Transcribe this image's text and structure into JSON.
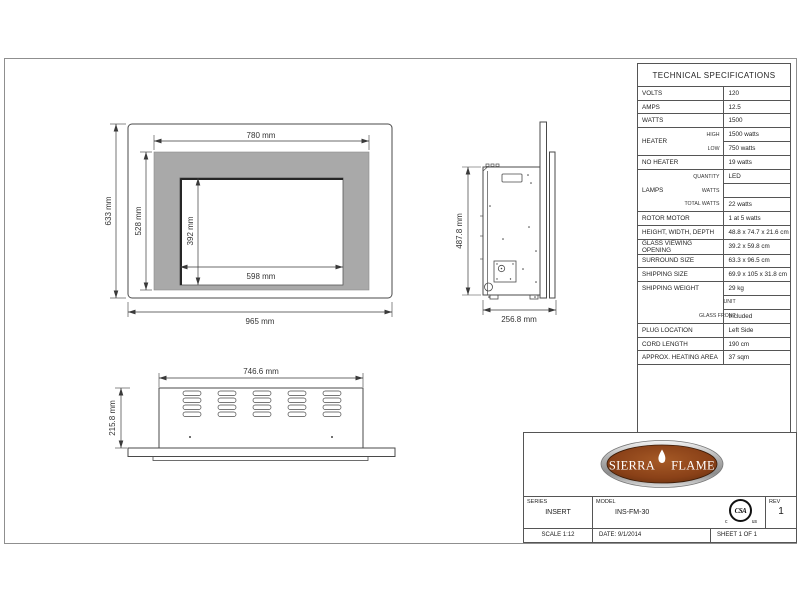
{
  "front_view": {
    "surround_width": "780 mm",
    "opening_width": "598 mm",
    "opening_height": "392 mm",
    "surround_height": "528 mm",
    "overall_height": "633 mm",
    "overall_width": "965 mm"
  },
  "side_view": {
    "height": "487.8 mm",
    "depth": "256.8 mm"
  },
  "top_view": {
    "width": "746.6 mm",
    "depth": "215.8 mm"
  },
  "specs": {
    "title": "TECHNICAL SPECIFICATIONS",
    "rows": [
      {
        "label": "VOLTS",
        "value": "120"
      },
      {
        "label": "AMPS",
        "value": "12.5"
      },
      {
        "label": "WATTS",
        "value": "1500"
      },
      {
        "group": "HEATER",
        "sub": "HIGH",
        "value": "1500 watts"
      },
      {
        "sub": "LOW",
        "value": "750 watts"
      },
      {
        "label": "NO HEATER",
        "value": "19 watts"
      },
      {
        "group": "LAMPS",
        "sub": "QUANTITY",
        "value": "LED"
      },
      {
        "sub": "WATTS",
        "value": ""
      },
      {
        "sub": "TOTAL WATTS",
        "value": "22 watts"
      },
      {
        "label": "ROTOR MOTOR",
        "value": "1 at 5 watts"
      },
      {
        "label": "HEIGHT, WIDTH, DEPTH",
        "value": "48.8 x 74.7 x 21.6 cm"
      },
      {
        "label": "GLASS VIEWING OPENING",
        "value": "39.2 x 59.8 cm"
      },
      {
        "label": "SURROUND SIZE",
        "value": "63.3 x 96.5 cm"
      },
      {
        "label": "SHIPPING SIZE",
        "value": "69.9 x 105 x 31.8 cm"
      },
      {
        "group": "SHIPPING WEIGHT",
        "sub": "",
        "value": "29 kg"
      },
      {
        "sub": "UNIT",
        "value": ""
      },
      {
        "sub": "GLASS FRONT",
        "value": "Included"
      },
      {
        "label": "PLUG LOCATION",
        "value": "Left Side"
      },
      {
        "label": "CORD LENGTH",
        "value": "190 cm"
      },
      {
        "label": "APPROX. HEATING AREA",
        "value": "37 sqm"
      }
    ]
  },
  "title_block": {
    "logo": {
      "brand_left": "SIERRA",
      "brand_right": "FLAME"
    },
    "csa_mark": {
      "monogram": "CSA",
      "left": "c",
      "right": "us"
    },
    "series_label": "SERIES",
    "series_value": "INSERT",
    "model_label": "MODEL",
    "model_value": "INS-FM-30",
    "rev_label": "REV",
    "rev_value": "1",
    "scale": "SCALE 1:12",
    "date": "DATE: 9/1/2014",
    "sheet_no": "SHEET 1 OF 1"
  },
  "colors": {
    "surround_gray": "#a9a9a9",
    "drawing_line": "#4a4a4a",
    "logo_brown": "#8a4118",
    "border_gray": "#8f8f8f"
  }
}
